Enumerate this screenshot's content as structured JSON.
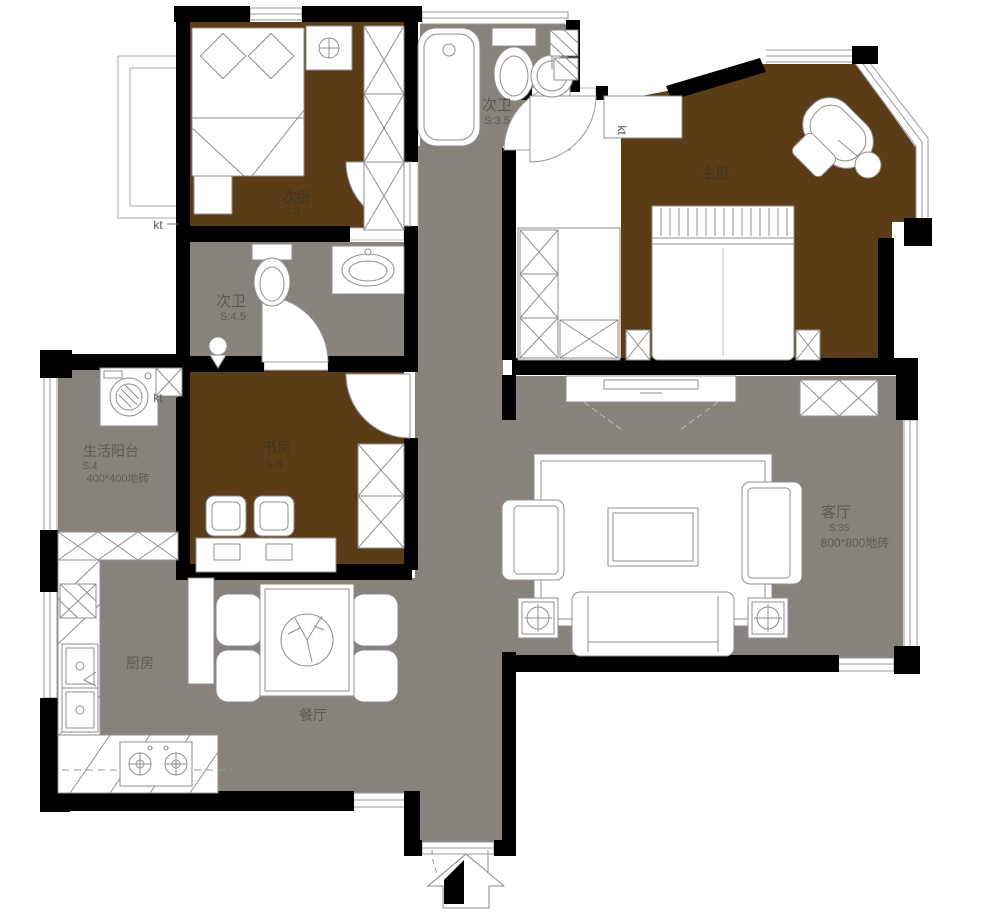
{
  "rooms": {
    "ciwo": {
      "name": "次卧",
      "area": "S:8"
    },
    "ciwei_top": {
      "name": "次卫",
      "area": "S:3.5"
    },
    "zhuwo": {
      "name": "主卧"
    },
    "ciwei_mid": {
      "name": "次卫",
      "area": "S:4.5"
    },
    "shufang": {
      "name": "书房",
      "area": "S:8"
    },
    "yangtai": {
      "name": "生活阳台",
      "area": "S:4",
      "floor": "400*400地砖"
    },
    "keting": {
      "name": "客厅",
      "area": "S:35",
      "floor": "800*800地砖"
    },
    "chufang": {
      "name": "厨房"
    },
    "canting": {
      "name": "餐厅"
    }
  },
  "labels": {
    "kt": "kt"
  },
  "colors": {
    "wood_floor": "#5a3c16",
    "tile_floor": "#87827b",
    "wall": "#000000",
    "fixture_stroke": "#8f8f8f"
  }
}
